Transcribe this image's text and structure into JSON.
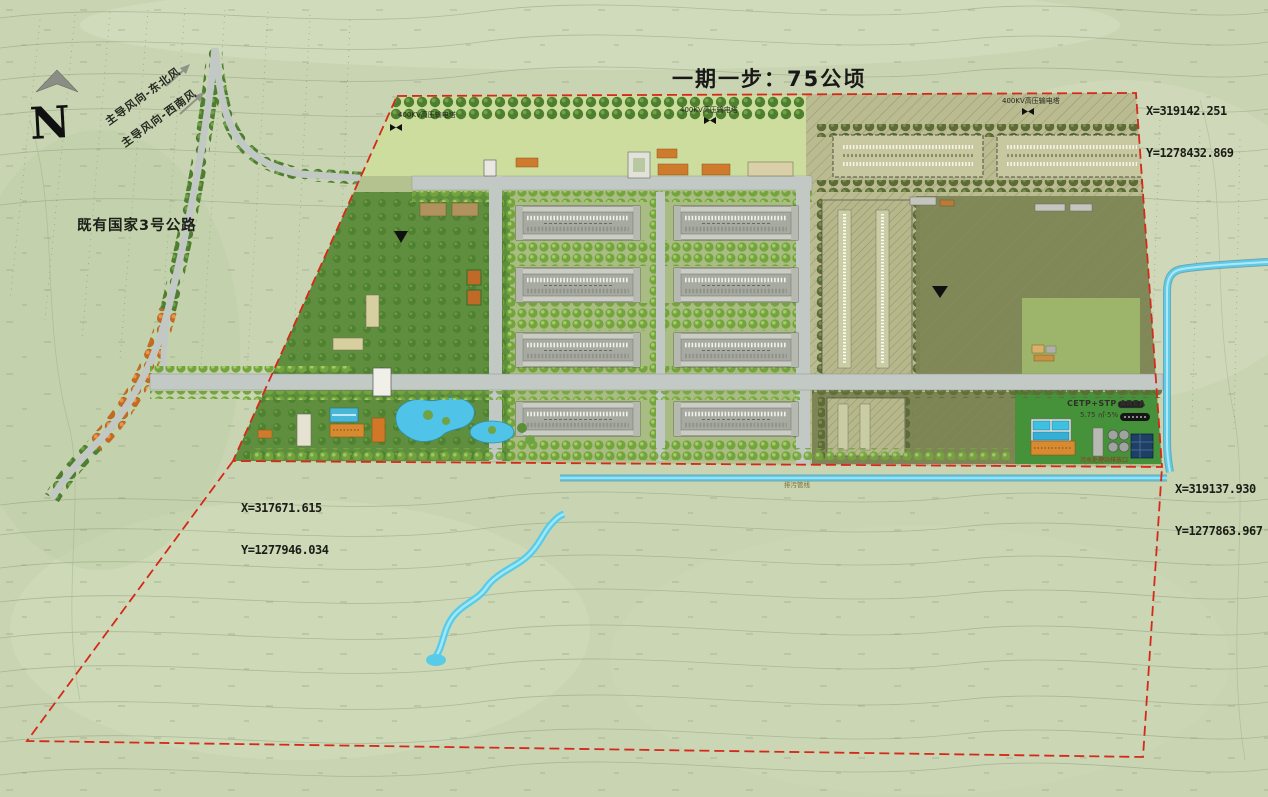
{
  "title": "一期一步：75公顷",
  "compass": {
    "letter": "N"
  },
  "wind": {
    "line1": "主导风向-东北风",
    "line2": "主导风向-西南风"
  },
  "labels": {
    "highway": "既有国家3号公路",
    "tower": "400KV高压输电塔",
    "pipeline": "排污管线",
    "outfall": "污水处理站排放口",
    "cetp_title": "CETP+STP AREA",
    "cetp_sub": "5.75 ㎡·5%"
  },
  "coordinates": {
    "top_right": {
      "x": "X=319142.251",
      "y": "Y=1278432.869"
    },
    "west": {
      "x": "X=317671.615",
      "y": "Y=1277946.034"
    },
    "east": {
      "x": "X=319137.930",
      "y": "Y=1277863.967"
    }
  },
  "colors": {
    "boundary_red": "#d5291a",
    "water_blue": "#5ecbe9",
    "road_gray": "#c3cac5",
    "park_green": "#5f8f3e",
    "future_khaki": "#babb90",
    "warehouse_gray": "#cbcdc5",
    "cetp_green": "#46923a",
    "autumn_tree_orange": "#cd7327",
    "background": "#c9d4b2"
  }
}
